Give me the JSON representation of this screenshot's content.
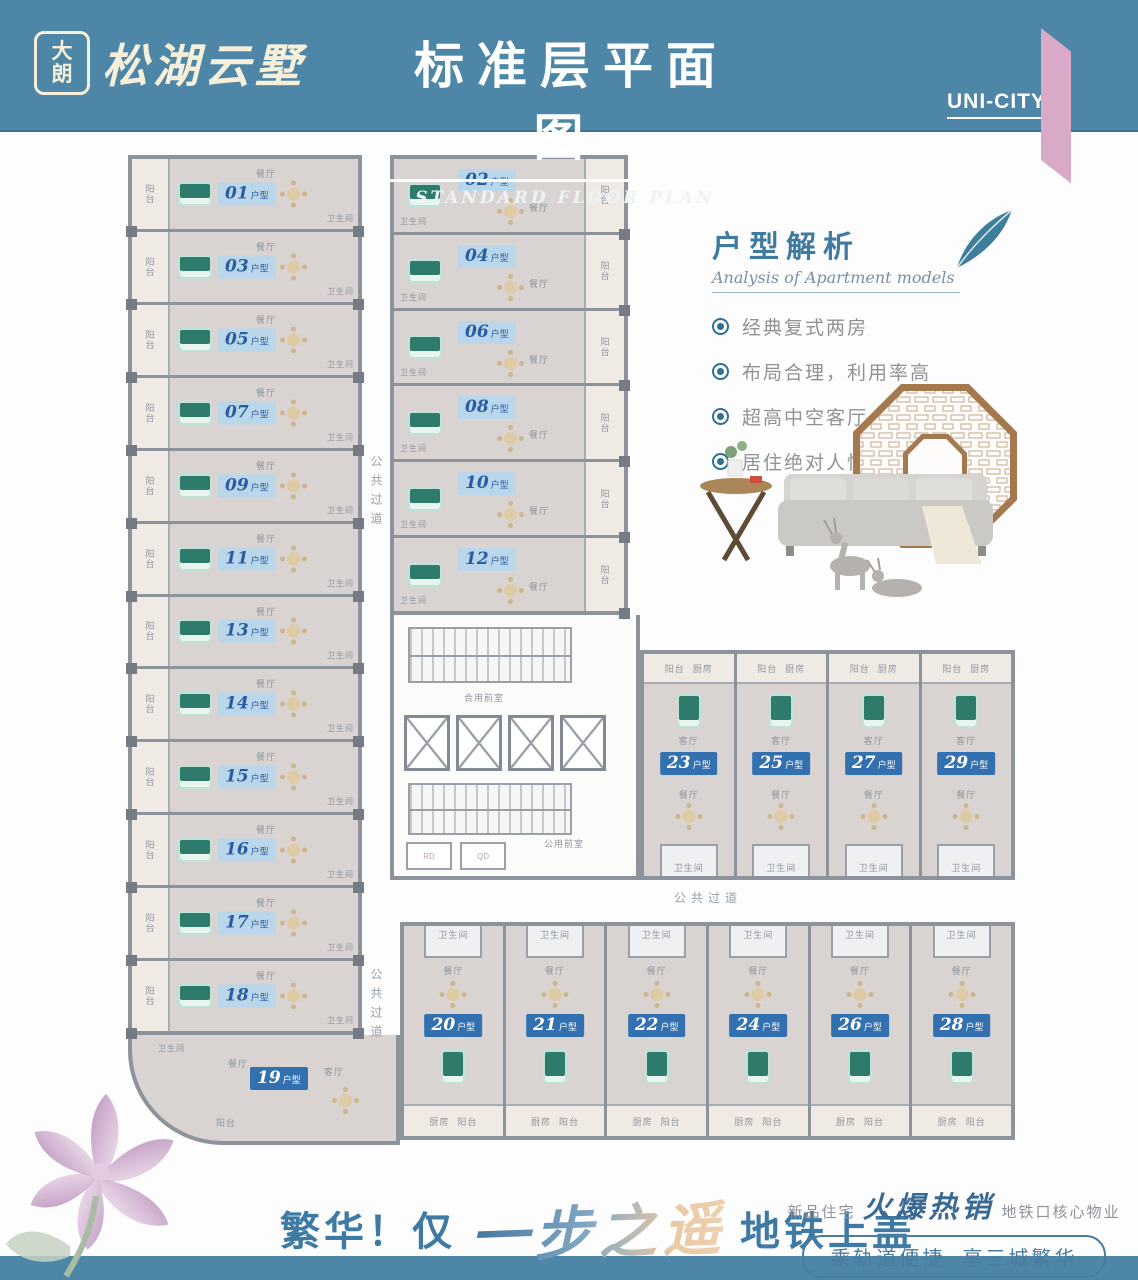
{
  "header": {
    "seal_top": "大",
    "seal_bottom": "朗",
    "brand": "松湖云墅",
    "title": "标准层平面图",
    "subtitle": "STANDARD FLOOR PLAN",
    "corner_tag": "UNI-CITY"
  },
  "analysis": {
    "title": "户型解析",
    "subtitle": "Analysis of Apartment models",
    "bullets": [
      "经典复式两房",
      "布局合理，利用率高",
      "超高中空客厅",
      "居住绝对人性化"
    ]
  },
  "plan": {
    "unit_suffix": "户型",
    "left_units": [
      "01",
      "03",
      "05",
      "07",
      "09",
      "11",
      "13",
      "14",
      "15",
      "16",
      "17",
      "18"
    ],
    "middle_units": [
      "02",
      "04",
      "06",
      "08",
      "10",
      "12"
    ],
    "corner_unit": "19",
    "right_top_units": [
      "23",
      "25",
      "27",
      "29"
    ],
    "right_bottom_units": [
      "20",
      "21",
      "22",
      "24",
      "26",
      "28"
    ],
    "corridor_label": "公共过道",
    "rooms": {
      "dining": "餐厅",
      "living": "客厅",
      "bath": "卫生间",
      "balcony": "阳台",
      "kitchen": "厨房"
    },
    "core": {
      "lobby_top": "合用前室",
      "lobby_bottom": "公用前室",
      "util_1": "RD",
      "util_2": "QD"
    }
  },
  "footer": {
    "slogan_prefix": "繁华！仅",
    "slogan_script": "一步之遥",
    "slogan_suffix": "地铁上盖",
    "promo_prefix": "新品住宅",
    "promo_script": "火爆热销",
    "promo_suffix": "地铁口核心物业",
    "pill": "乘轨道便捷  享三城繁华"
  },
  "colors": {
    "header_blue": "#4d86a7",
    "ribbon_pink": "#d9aac8",
    "badge_light_bg": "#b9d6ea",
    "badge_light_text": "#2a5d9f",
    "badge_solid_bg": "#3370af",
    "accent_blue": "#3f7aa5",
    "wall_gray": "#8d939b",
    "floor_gray": "#d9d4d1"
  }
}
